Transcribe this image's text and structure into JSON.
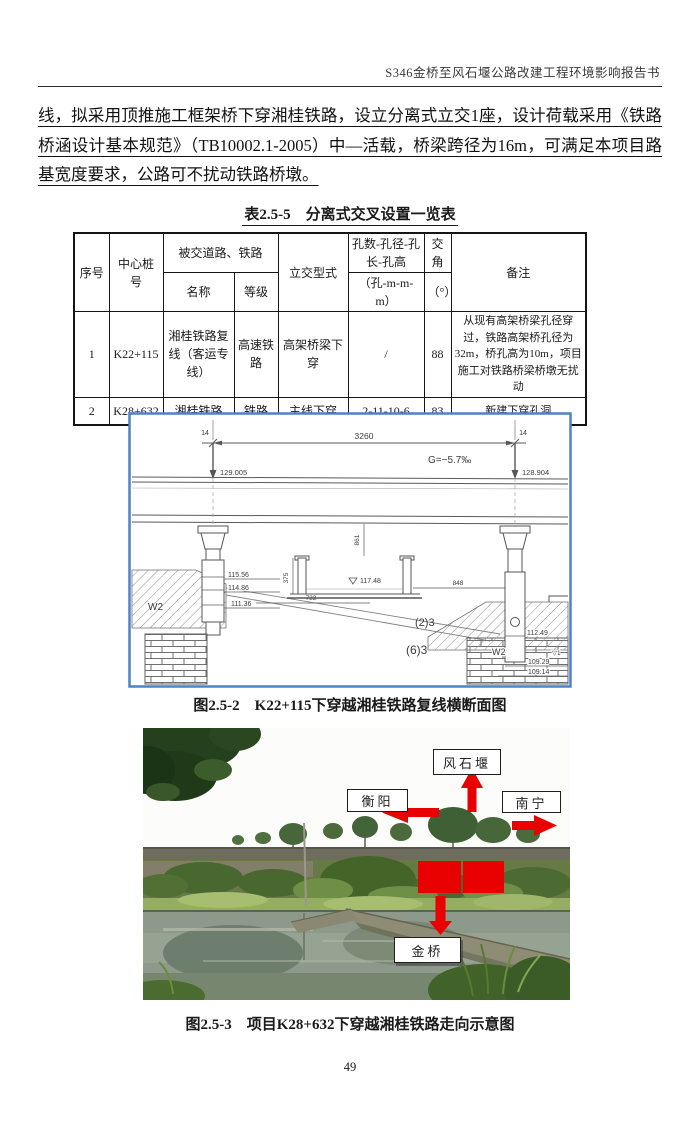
{
  "header": {
    "title": "S346金桥至风石堰公路改建工程环境影响报告书"
  },
  "paragraph": "线，拟采用顶推施工框架桥下穿湘桂铁路，设立分离式立交1座，设计荷载采用《铁路桥涵设计基本规范》（TB10002.1-2005）中—活载，桥梁跨径为16m，可满足本项目路基宽度要求，公路可不扰动铁路桥墩。",
  "table": {
    "caption": "表2.5-5　分离式交叉设置一览表",
    "col_no": "序号",
    "col_station": "中心桩号",
    "col_group": "被交道路、铁路",
    "col_name": "名称",
    "col_grade": "等级",
    "col_type": "立交型式",
    "col_holes": "孔数-孔径-孔长-孔高",
    "col_holes_unit": "（孔-m-m-m）",
    "col_angle": "交角",
    "col_angle_unit": "（°）",
    "col_remark": "备注",
    "rows": [
      {
        "no": "1",
        "station": "K22+115",
        "name": "湘桂铁路复线（客运专线）",
        "grade": "高速铁路",
        "type": "高架桥梁下穿",
        "holes": "/",
        "angle": "88",
        "remark": "从现有高架桥梁孔径穿过，铁路高架桥孔径为32m，桥孔高为10m，项目施工对铁路桥梁桥墩无扰动"
      },
      {
        "no": "2",
        "station": "K28+632",
        "name": "湘桂铁路",
        "grade": "铁路",
        "type": "主线下穿",
        "holes": "2-11-10-6",
        "angle": "83",
        "remark": "新建下穿孔洞"
      }
    ]
  },
  "figure1": {
    "caption": "图2.5-2　K22+115下穿越湘桂铁路复线横断面图",
    "border_color": "#4d82c6",
    "labels": {
      "span": "3260",
      "offset_left": "14",
      "offset_right": "14",
      "elev_rail_left": "129.005",
      "elev_rail_right": "128.904",
      "grade": "G=−5.7‰",
      "elev_road": "117.48",
      "dim_732": "732",
      "dim_848": "848",
      "dim_375": "375",
      "dim_861": "861",
      "wall_left": "W2",
      "wall_right": "W2",
      "elev_115_56": "115.56",
      "elev_114_86": "114.86",
      "elev_111_36": "111.36",
      "elev_112_49": "112.49",
      "elev_109_29": "109.29",
      "elev_109_14": "109.14",
      "track_a": "(2)3",
      "track_b": "(6)3",
      "marker_right": "▽1"
    }
  },
  "figure2": {
    "caption": "图2.5-3　项目K28+632下穿越湘桂铁路走向示意图",
    "arrow_color": "#e90000",
    "labels": {
      "north": "风石堰",
      "west": "衡阳",
      "east": "南宁",
      "south": "金桥"
    }
  },
  "page_number": "49"
}
